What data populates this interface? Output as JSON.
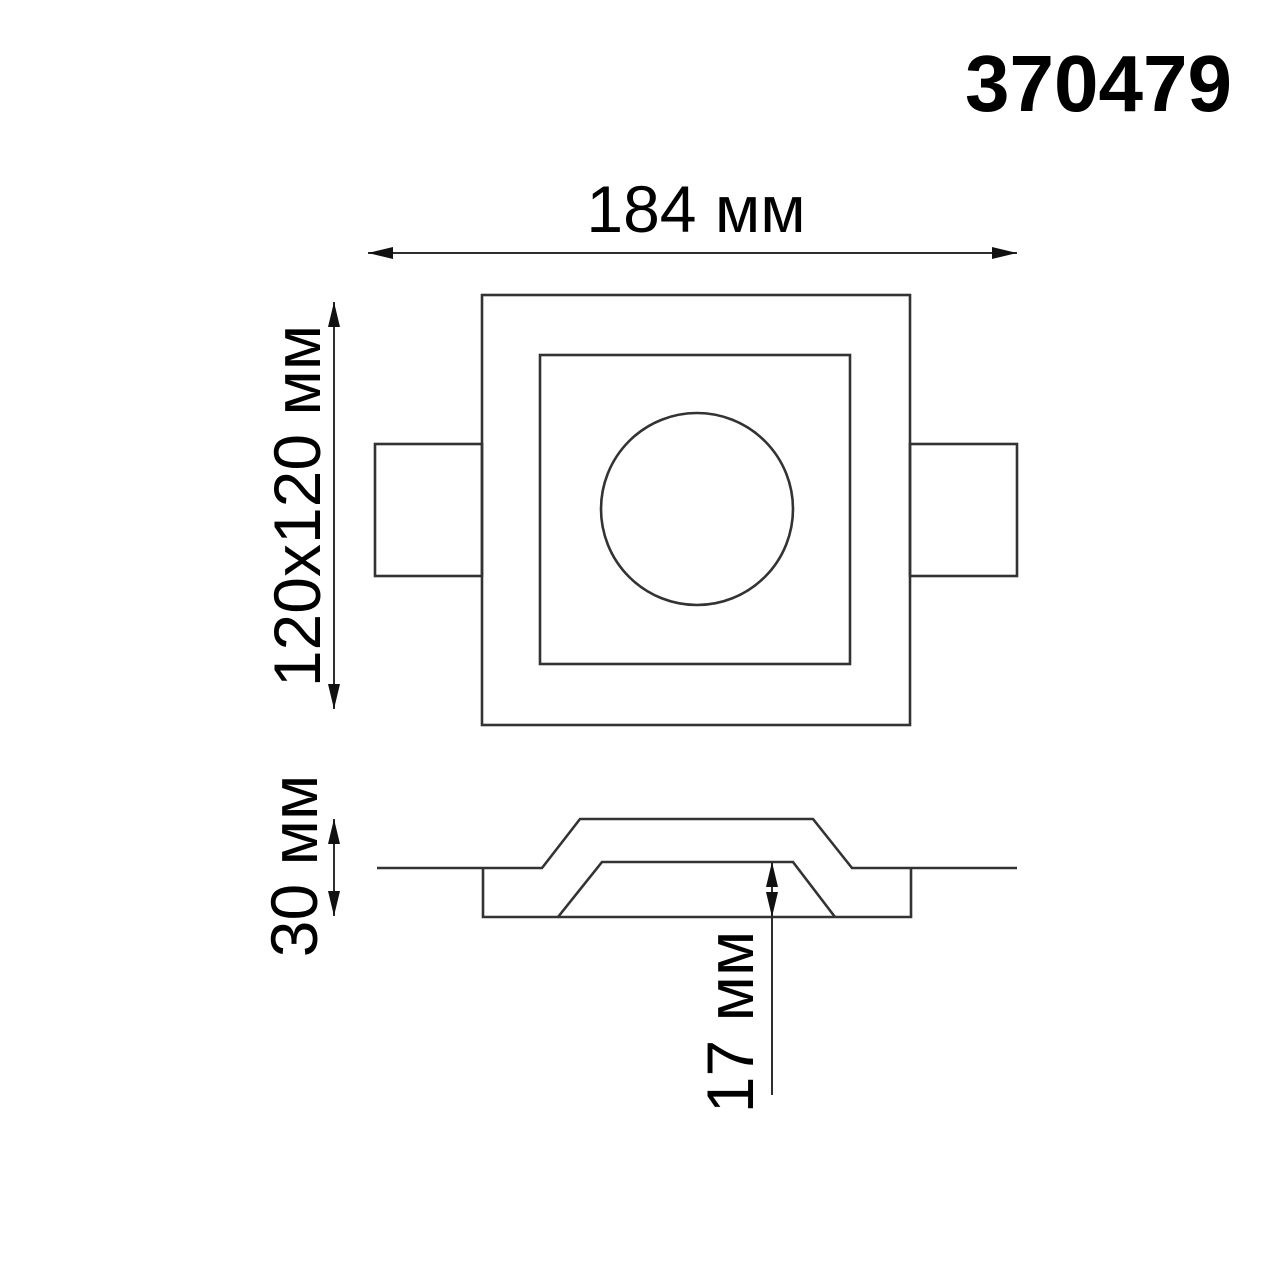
{
  "page": {
    "background_color": "#ffffff",
    "line_color": "#333333",
    "text_color": "#000000"
  },
  "header": {
    "product_code": "370479"
  },
  "top_view": {
    "width_dimension_label": "184 мм",
    "face_dimension_label": "120x120 мм"
  },
  "section_view": {
    "height_dimension_label": "30 мм",
    "recess_depth_dimension_label": "17 мм"
  }
}
